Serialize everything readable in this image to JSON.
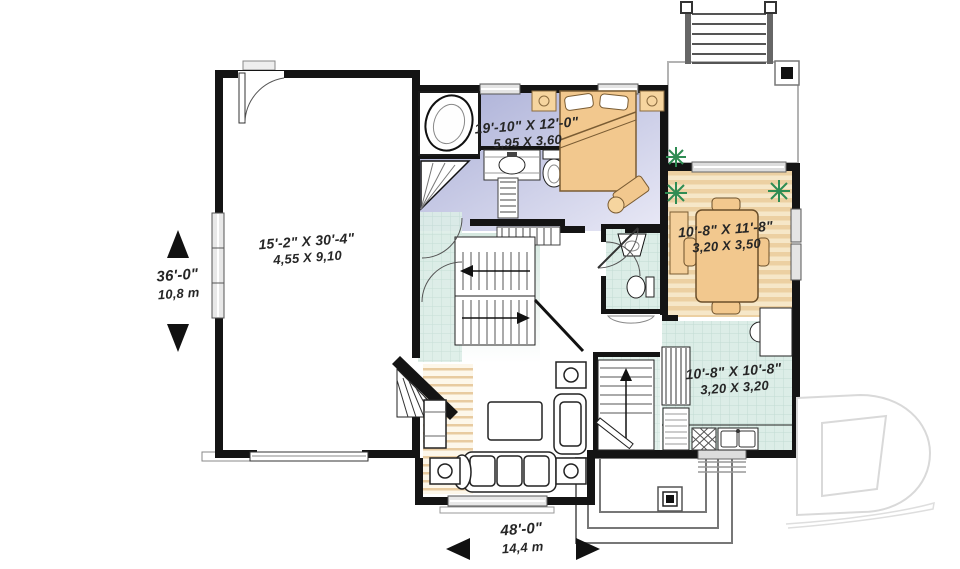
{
  "labels": {
    "bedroom": {
      "imperial": "19'-10\" X 12'-0\"",
      "metric": "5,95 X 3,60"
    },
    "garage": {
      "imperial": "15'-2\" X 30'-4\"",
      "metric": "4,55 X 9,10"
    },
    "dining": {
      "imperial": "10'-8\" X 11'-8\"",
      "metric": "3,20 X 3,50"
    },
    "kitchen": {
      "imperial": "10'-8\" X 10'-8\"",
      "metric": "3,20 X 3,20"
    }
  },
  "dimensions": {
    "vertical": {
      "imperial": "36'-0\"",
      "metric": "10,8 m"
    },
    "horizontal": {
      "imperial": "48'-0\"",
      "metric": "14,4 m"
    }
  },
  "watermark": {
    "logo": "drummond-d-logo"
  },
  "colors": {
    "wall": "#141414",
    "bedroom_floor_start": "#a9aed6",
    "bedroom_floor_end": "#e9e9f6",
    "wood_floor": "#ecd0a2",
    "wood_floor_light": "#f6e7c8",
    "tile_floor": "#dcede7",
    "tile_line": "#c2dcd3",
    "furniture": "#f2c88e",
    "plant": "#2f8c53"
  }
}
